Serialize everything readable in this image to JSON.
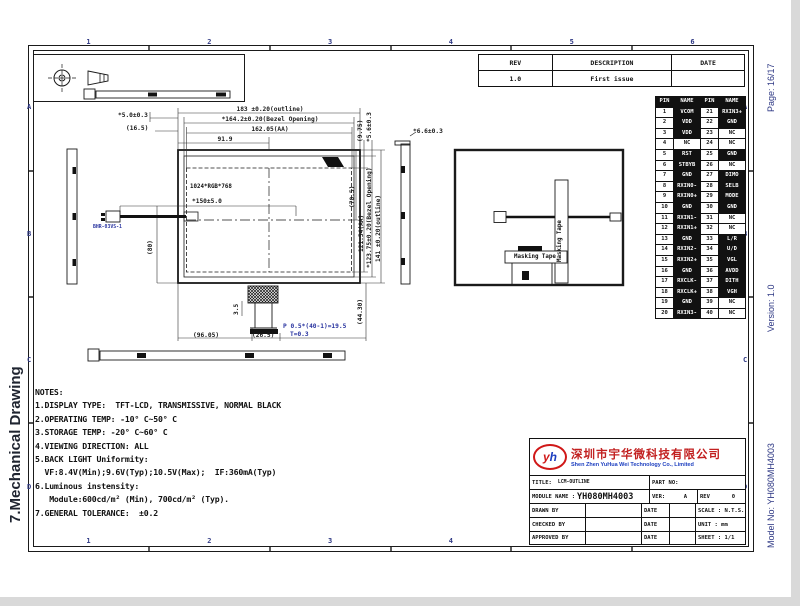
{
  "page": {
    "left_title": "7.Mechanical Drawing",
    "page_no": "Page: 16/17",
    "version": "Version: 1.0",
    "model_no": "Model No: YH080MH4003"
  },
  "frame": {
    "columns": [
      "1",
      "2",
      "3",
      "4",
      "5",
      "6"
    ],
    "rows": [
      "A",
      "B",
      "C",
      "D"
    ]
  },
  "icons": {
    "projection": "third-angle-projection-symbol"
  },
  "rev_table": {
    "headers": [
      "REV",
      "DESCRIPTION",
      "DATE"
    ],
    "rows": [
      [
        "1.0",
        "First issue",
        ""
      ]
    ]
  },
  "pin_table": {
    "headers": [
      "PIN",
      "NAME",
      "PIN",
      "NAME"
    ],
    "left": [
      {
        "pin": "1",
        "name": "VCOM",
        "filled": true
      },
      {
        "pin": "2",
        "name": "VDD",
        "filled": true
      },
      {
        "pin": "3",
        "name": "VDD",
        "filled": true
      },
      {
        "pin": "4",
        "name": "NC",
        "filled": false
      },
      {
        "pin": "5",
        "name": "RST",
        "filled": true
      },
      {
        "pin": "6",
        "name": "STBYB",
        "filled": true
      },
      {
        "pin": "7",
        "name": "GND",
        "filled": true
      },
      {
        "pin": "8",
        "name": "RXIN0-",
        "filled": true
      },
      {
        "pin": "9",
        "name": "RXIN0+",
        "filled": true
      },
      {
        "pin": "10",
        "name": "GND",
        "filled": true
      },
      {
        "pin": "11",
        "name": "RXIN1-",
        "filled": true
      },
      {
        "pin": "12",
        "name": "RXIN1+",
        "filled": true
      },
      {
        "pin": "13",
        "name": "GND",
        "filled": true
      },
      {
        "pin": "14",
        "name": "RXIN2-",
        "filled": true
      },
      {
        "pin": "15",
        "name": "RXIN2+",
        "filled": true
      },
      {
        "pin": "16",
        "name": "GND",
        "filled": true
      },
      {
        "pin": "17",
        "name": "RXCLK-",
        "filled": true
      },
      {
        "pin": "18",
        "name": "RXCLK+",
        "filled": true
      },
      {
        "pin": "19",
        "name": "GND",
        "filled": true
      },
      {
        "pin": "20",
        "name": "RXIN3-",
        "filled": true
      }
    ],
    "right": [
      {
        "pin": "21",
        "name": "RXIN3+",
        "filled": true
      },
      {
        "pin": "22",
        "name": "GND",
        "filled": true
      },
      {
        "pin": "23",
        "name": "NC",
        "filled": false
      },
      {
        "pin": "24",
        "name": "NC",
        "filled": false
      },
      {
        "pin": "25",
        "name": "GND",
        "filled": true
      },
      {
        "pin": "26",
        "name": "NC",
        "filled": false
      },
      {
        "pin": "27",
        "name": "DIMO",
        "filled": true
      },
      {
        "pin": "28",
        "name": "SELB",
        "filled": true
      },
      {
        "pin": "29",
        "name": "MODE",
        "filled": true
      },
      {
        "pin": "30",
        "name": "GND",
        "filled": true
      },
      {
        "pin": "31",
        "name": "NC",
        "filled": false
      },
      {
        "pin": "32",
        "name": "NC",
        "filled": false
      },
      {
        "pin": "33",
        "name": "L/R",
        "filled": true
      },
      {
        "pin": "34",
        "name": "U/D",
        "filled": true
      },
      {
        "pin": "35",
        "name": "VGL",
        "filled": true
      },
      {
        "pin": "36",
        "name": "AVDD",
        "filled": true
      },
      {
        "pin": "37",
        "name": "DITH",
        "filled": true
      },
      {
        "pin": "38",
        "name": "VGH",
        "filled": true
      },
      {
        "pin": "39",
        "name": "NC",
        "filled": false
      },
      {
        "pin": "40",
        "name": "NC",
        "filled": false
      }
    ]
  },
  "dims": {
    "outline_w": "183 ±0.20(outline)",
    "bezel_w": "*164.2±0.20(Bezel Opening)",
    "aa_w": "162.05(AA)",
    "half_w": "91.9",
    "tab_h": "*5.0±0.3",
    "edge_16_5": "(16.5)",
    "gap_9_75": "(9.75)",
    "tab_v": "*5.6±0.3",
    "cable_y": "(70.5)",
    "aa_h": "121.54(AA)",
    "bezel_h": "*123.75±0.20(Bezel Opening)",
    "outline_h": "141 ±0.20(outline)",
    "thickness": "*6.6±0.3",
    "cable_len": "*150±5.0",
    "cable_drop": "(80)",
    "fpc_35": "3.5",
    "fpc_96": "(96.05)",
    "fpc_26": "(26.5)",
    "fpc_pitch": "P 0.5*(40-1)=19.5",
    "fpc_t": "T=0.3",
    "fpc_len": "(44.30)"
  },
  "labels": {
    "resolution": "1024*RGB*768",
    "masking_tape_v": "Masking Tape",
    "masking_tape_h": "Masking Tape",
    "connector": "BHR-03VS-1"
  },
  "notes": {
    "title": "NOTES:",
    "lines": [
      "1.DISPLAY TYPE:  TFT-LCD, TRANSMISSIVE, NORMAL BLACK",
      "2.OPERATING TEMP: -10° C~50° C",
      "3.STORAGE TEMP: -20° C~60° C",
      "4.VIEWING DIRECTION: ALL",
      "5.BACK LIGHT Uniformity:",
      "  VF:8.4V(Min);9.6V(Typ);10.5V(Max);  IF:360mA(Typ)",
      "6.Luminous instensity:",
      "   Module:600cd/m² (Min), 700cd/m² (Typ).",
      "7.GENERAL TOLERANCE:  ±0.2"
    ]
  },
  "title_block": {
    "company_cn": "深圳市宇华微科技有限公司",
    "company_en": "Shen Zhen YuHua Wei Technology Co., Limited",
    "logo_y": "y",
    "logo_h": "h",
    "title_label": "TITLE:",
    "title_value": "LCM-OUTLINE",
    "part_no_label": "PART NO:",
    "module_name_label": "MODULE NAME :",
    "module_name_value": "YH080MH4003",
    "ver_label": "VER:",
    "ver_value": "A",
    "rev_label": "REV",
    "rev_value": "0",
    "drawn_by": "DRAWN BY",
    "checked_by": "CHECKED BY",
    "approved_by": "APPROVED BY",
    "date_label": "DATE",
    "scale": "SCALE : N.T.S.",
    "unit": "UNIT : mm",
    "sheet": "SHEET : 1/1"
  }
}
